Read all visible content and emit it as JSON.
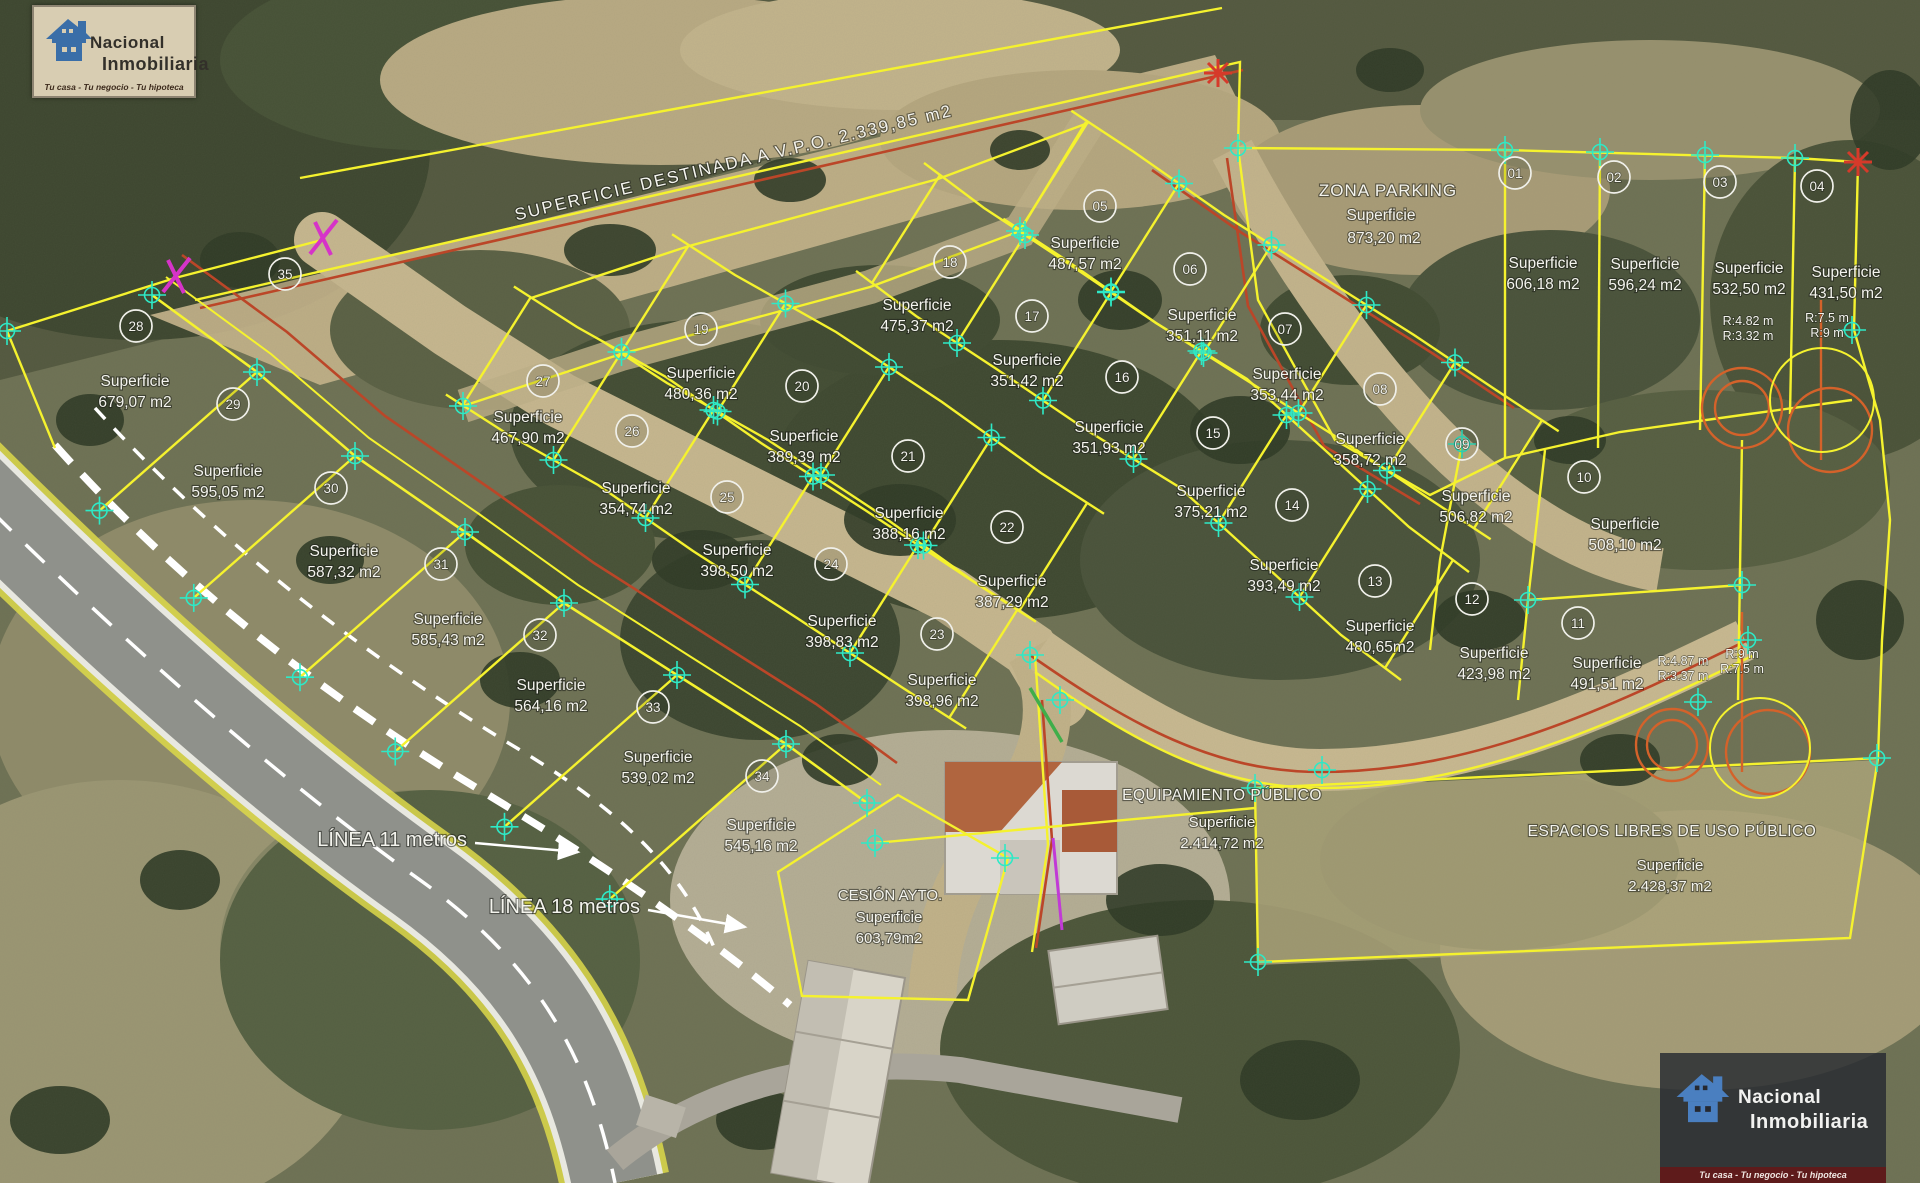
{
  "branding": {
    "logo_top_left": {
      "name_line1": "Nacional",
      "name_line2": "Inmobiliaria",
      "tagline": "Tu casa - Tu negocio - Tu hipoteca"
    },
    "logo_bottom_right": {
      "name_line1": "Nacional",
      "name_line2": "Inmobiliaria",
      "tagline": "Tu casa - Tu negocio - Tu hipoteca"
    }
  },
  "labels": {
    "superficie": "Superficie"
  },
  "zones": {
    "vpo_strip": {
      "label": "SUPERFICIE DESTINADA A V.P.O. 2.339,85 m2"
    },
    "zona_parking": {
      "title": "ZONA PARKING",
      "area": "873,20 m2"
    },
    "equipamiento": {
      "title": "EQUIPAMIENTO PÚBLICO",
      "area": "2.414,72 m2"
    },
    "espacios_libres": {
      "title": "ESPACIOS LIBRES DE USO PÚBLICO",
      "area": "2.428,37 m2"
    },
    "cesion": {
      "title": "CESIÓN AYTO.",
      "area": "603,79m2"
    }
  },
  "annotations": {
    "linea_11": "LÍNEA 11 metros",
    "linea_18": "LÍNEA 18 metros",
    "radius_labels": [
      {
        "lines": [
          "R:4.82 m",
          "R:3.32 m"
        ]
      },
      {
        "lines": [
          "R:7.5 m",
          "R:9 m"
        ]
      },
      {
        "lines": [
          "R:4.87 m",
          "R:3.37 m"
        ]
      },
      {
        "lines": [
          "R:9 m",
          "R:7.5 m"
        ]
      }
    ]
  },
  "plots": [
    {
      "number": "01",
      "area": "606,18 m2"
    },
    {
      "number": "02",
      "area": "596,24 m2"
    },
    {
      "number": "03",
      "area": "532,50 m2"
    },
    {
      "number": "04",
      "area": "431,50 m2"
    },
    {
      "number": "05",
      "area": "487,57 m2"
    },
    {
      "number": "06",
      "area": "351,11 m2"
    },
    {
      "number": "07",
      "area": "353,44 m2"
    },
    {
      "number": "08",
      "area": "358,72 m2"
    },
    {
      "number": "09",
      "area": "506,82 m2"
    },
    {
      "number": "10",
      "area": "508,10 m2"
    },
    {
      "number": "11",
      "area": "491,51 m2"
    },
    {
      "number": "12",
      "area": "423,98 m2"
    },
    {
      "number": "13",
      "area": "480,65m2"
    },
    {
      "number": "14",
      "area": "393,49 m2"
    },
    {
      "number": "15",
      "area": "375,21 m2"
    },
    {
      "number": "16",
      "area": "351,93 m2"
    },
    {
      "number": "17",
      "area": "351,42 m2"
    },
    {
      "number": "18",
      "area": "475,37 m2"
    },
    {
      "number": "19",
      "area": "480,36 m2"
    },
    {
      "number": "20",
      "area": "389,39 m2"
    },
    {
      "number": "21",
      "area": "388,16 m2"
    },
    {
      "number": "22",
      "area": "387,29 m2"
    },
    {
      "number": "23",
      "area": "398,96 m2"
    },
    {
      "number": "24",
      "area": "398,83 m2"
    },
    {
      "number": "25",
      "area": "398,50 m2"
    },
    {
      "number": "26",
      "area": "354,74 m2"
    },
    {
      "number": "27",
      "area": "467,90 m2"
    },
    {
      "number": "28",
      "area": "679,07 m2"
    },
    {
      "number": "29",
      "area": "595,05 m2"
    },
    {
      "number": "30",
      "area": "587,32 m2"
    },
    {
      "number": "31",
      "area": "585,43 m2"
    },
    {
      "number": "32",
      "area": "564,16 m2"
    },
    {
      "number": "33",
      "area": "539,02 m2"
    },
    {
      "number": "34",
      "area": "545,16 m2"
    },
    {
      "number": "35",
      "area": null
    }
  ],
  "colors": {
    "parcel_line": "#f5f22e",
    "road_edge_red": "#bb4628",
    "marker": "#2ee9c6",
    "label_text": "#f4f4ee",
    "dashed_line": "#ffffff",
    "turn_circle": "#d4622a"
  }
}
